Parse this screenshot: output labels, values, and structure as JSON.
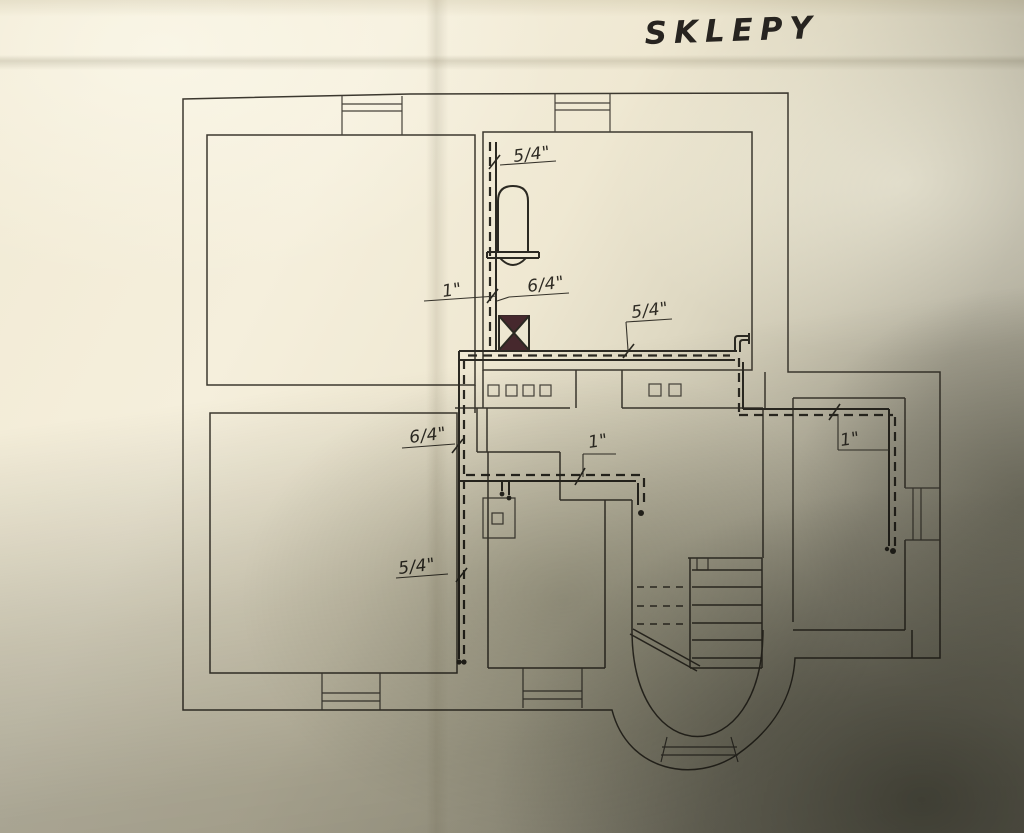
{
  "drawing": {
    "title": "SKLEPY",
    "dimension_labels": [
      {
        "text": "5/4\"",
        "location": "riser-top-near-boiler"
      },
      {
        "text": "1\"",
        "location": "left-wall-riser"
      },
      {
        "text": "6/4\"",
        "location": "boiler-outlet"
      },
      {
        "text": "5/4\"",
        "location": "main-horizontal-run"
      },
      {
        "text": "6/4\"",
        "location": "left-chase-upper"
      },
      {
        "text": "1\"",
        "location": "middle-branch"
      },
      {
        "text": "1\"",
        "location": "right-wing-branch"
      },
      {
        "text": "5/4\"",
        "location": "left-chase-lower"
      }
    ],
    "symbols": [
      {
        "name": "boiler-tank"
      },
      {
        "name": "valve"
      },
      {
        "name": "staircase"
      },
      {
        "name": "bay-window"
      },
      {
        "name": "chimney-flues"
      }
    ],
    "colors": {
      "ink": "#3c382f",
      "pipe_ink": "#2b2922",
      "valve_fill": "#46282d",
      "paper": "#f2ecd8",
      "shadow": "#55544a"
    }
  }
}
